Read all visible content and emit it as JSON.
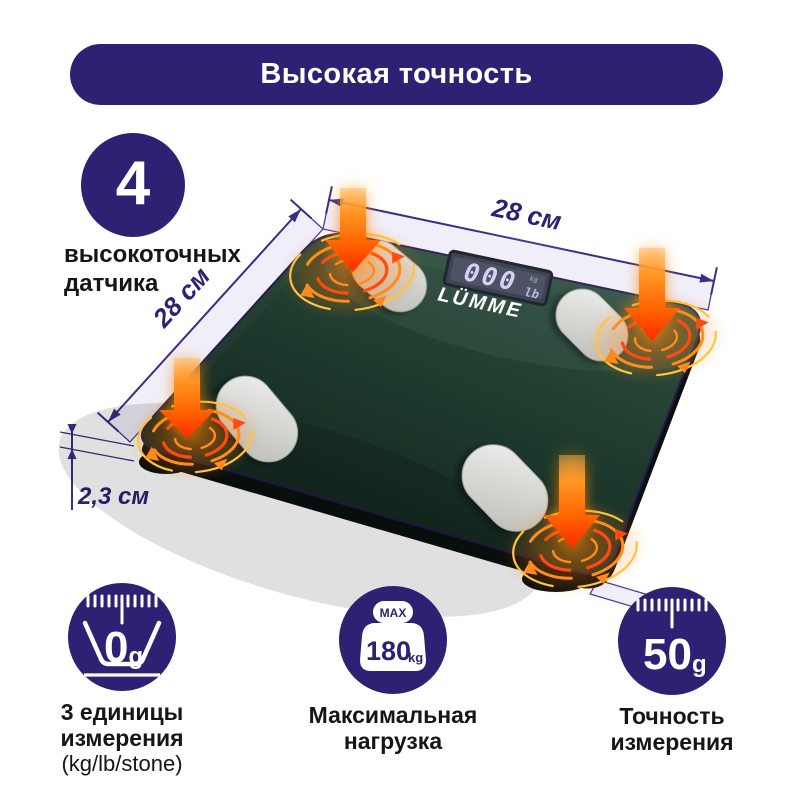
{
  "banner": {
    "title": "Высокая точность"
  },
  "sensors_badge": {
    "count": "4",
    "line1": "высокоточных",
    "line2": "датчика"
  },
  "dimensions": {
    "width_top": "28 см",
    "width_left": "28 см",
    "height": "2,3 см"
  },
  "scale": {
    "brand": "LÜMME",
    "lcd_value": "000",
    "lcd_unit": "lb",
    "lcd_unit_small": "kg"
  },
  "features": [
    {
      "icon": "units-scale-icon",
      "icon_value": "0",
      "icon_unit": "g",
      "lines": [
        "3 единицы",
        "измерения",
        "(kg/lb/stone)"
      ]
    },
    {
      "icon": "max-load-weight-icon",
      "icon_top": "MAX",
      "icon_value": "180",
      "icon_unit": "kg",
      "lines": [
        "Максимальная",
        "нагрузка"
      ]
    },
    {
      "icon": "accuracy-ruler-icon",
      "icon_value": "50",
      "icon_unit": "g",
      "lines": [
        "Точность",
        "измерения"
      ]
    }
  ],
  "colors": {
    "primary_purple": "#2e2173",
    "dimension_line": "#3b2d85",
    "band_fill": "#f0eef9",
    "surface_green_light": "#2d5140",
    "surface_green_dark": "#10201a",
    "arrow_orange": "#ff6a00",
    "swirl_yellow": "#ffc43f",
    "pad_silver": "#d8d8d4"
  }
}
